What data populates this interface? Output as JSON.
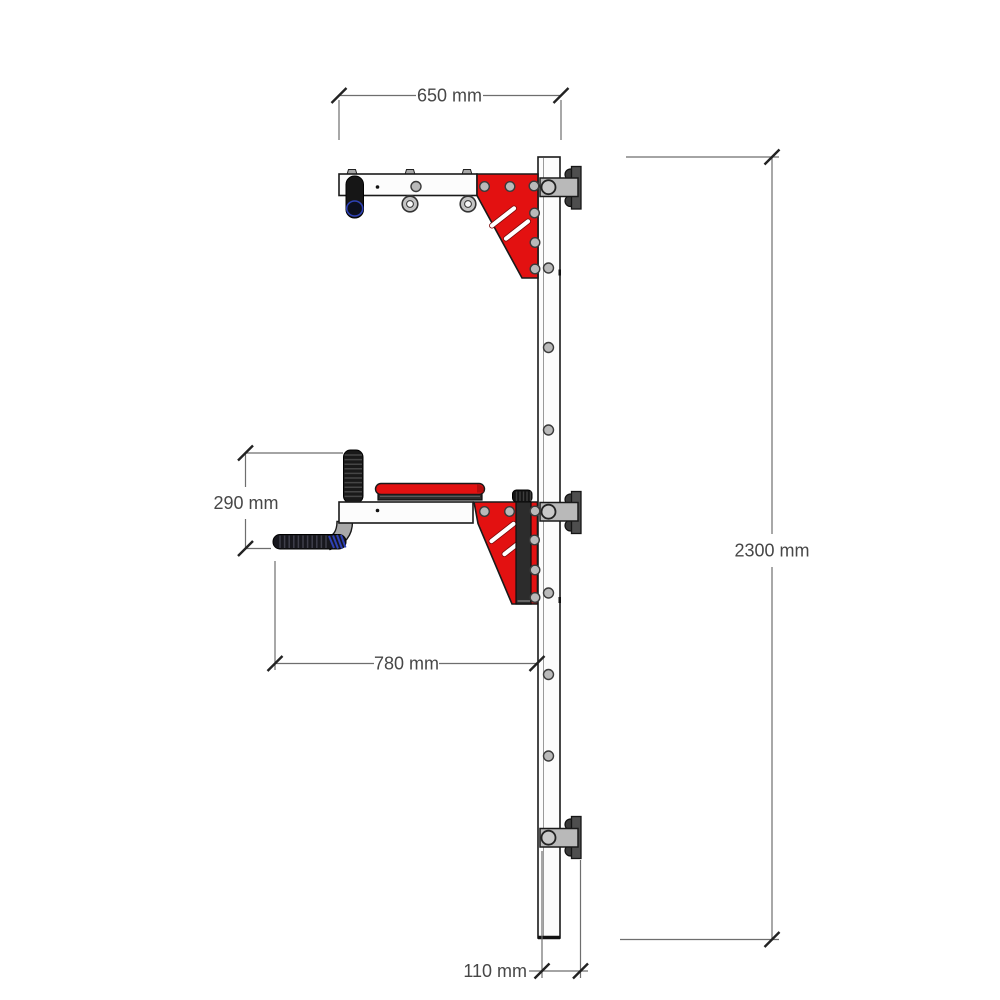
{
  "page": {
    "background": "#ffffff"
  },
  "colors": {
    "accent_red": "#e31111",
    "accent_red_dark": "#b30d0d",
    "frame_fill": "#fcfcfc",
    "outline": "#1a1a1a",
    "steel_gray": "#b9b9b9",
    "steel_light": "#c9c9c9",
    "plate_gray": "#4e4e4e",
    "foam_black": "#17171d",
    "rib_gray": "#3f3f4a",
    "grip_blue": "#2e41b5",
    "dim_line": "#6e6e6e",
    "dim_text": "#474747",
    "bg": "#ffffff"
  },
  "dims": {
    "arm_length": {
      "label": "650 mm",
      "value_mm": 650,
      "unit": "mm"
    },
    "overall_height": {
      "label": "2300 mm",
      "value_mm": 2300,
      "unit": "mm"
    },
    "grip_rise": {
      "label": "290 mm",
      "value_mm": 290,
      "unit": "mm"
    },
    "dip_reach": {
      "label": "780 mm",
      "value_mm": 780,
      "unit": "mm"
    },
    "mount_depth": {
      "label": "110 mm",
      "value_mm": 110,
      "unit": "mm"
    }
  }
}
